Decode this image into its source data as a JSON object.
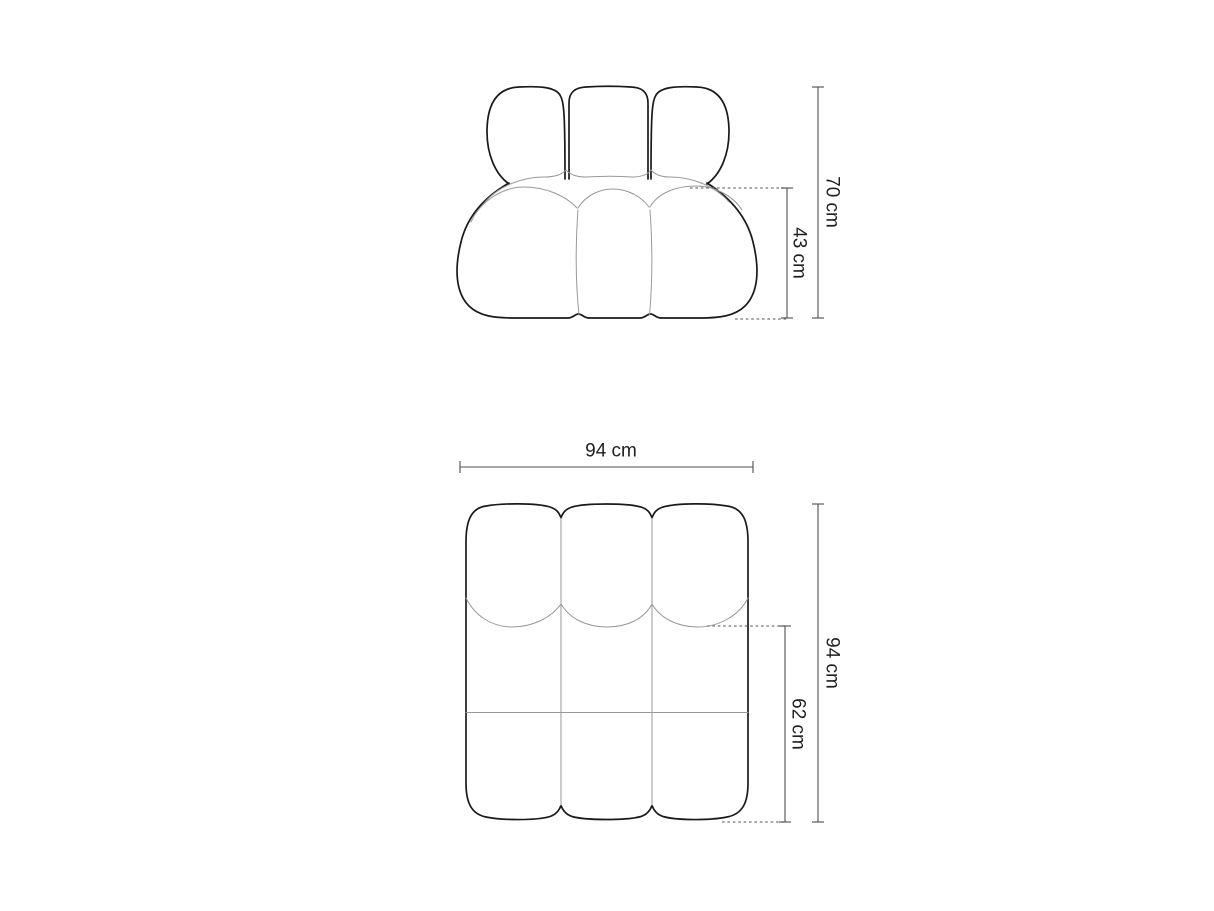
{
  "front_view": {
    "total_height": "70 cm",
    "seat_height": "43 cm"
  },
  "top_view": {
    "width": "94 cm",
    "total_depth": "94 cm",
    "seat_depth": "62 cm"
  },
  "colors": {
    "background": "#ffffff",
    "outline": "#1a1a1a",
    "seam": "#999999",
    "dimension_line": "#4f4f4f",
    "dotted_line": "#737373",
    "label_text": "#1f1f1f"
  }
}
